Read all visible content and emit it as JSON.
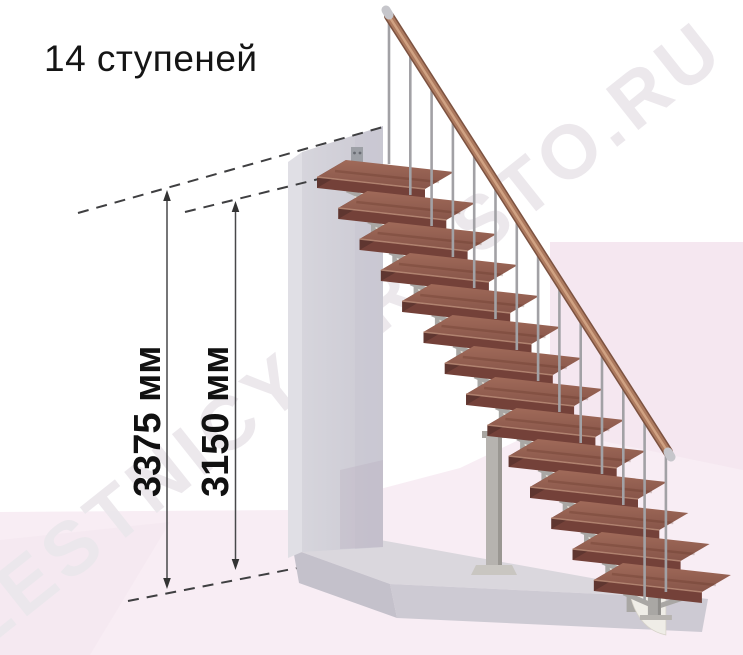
{
  "title": "14 ступеней",
  "watermark": "LESTNICY-PROSTO.RU",
  "dimensions": {
    "total_height": "3375 мм",
    "stair_height": "3150 мм"
  },
  "stairs": {
    "steps_count": 14
  },
  "colors": {
    "tread_top_light": "#9d6757",
    "tread_top_dark": "#8a584c",
    "tread_front": "#744139",
    "tread_side": "#5f3630",
    "tread_nose": "#b88a76",
    "metal": "#a9a7a4",
    "metal_shade": "#8f8d8a",
    "sail": "#efede7",
    "baluster": "#a2a1a5",
    "rail_dark": "#7c5240",
    "rail_main": "#ad7a5f",
    "rail_highlight": "#d4a787",
    "rail_cap": "#c6c6cb",
    "wall_front": "#d3d2d9",
    "wall_side": "#e0dfe5",
    "wall_shade": "#c9c7d1",
    "slab_top": "#dad7dd",
    "slab_front": "#cdcad3",
    "slab_side": "#c4c1cb",
    "pink_main": "#f8edf4",
    "pink_deep": "#f2e2ec",
    "dim_line": "#48484a",
    "dash_line": "#3f3f41"
  }
}
